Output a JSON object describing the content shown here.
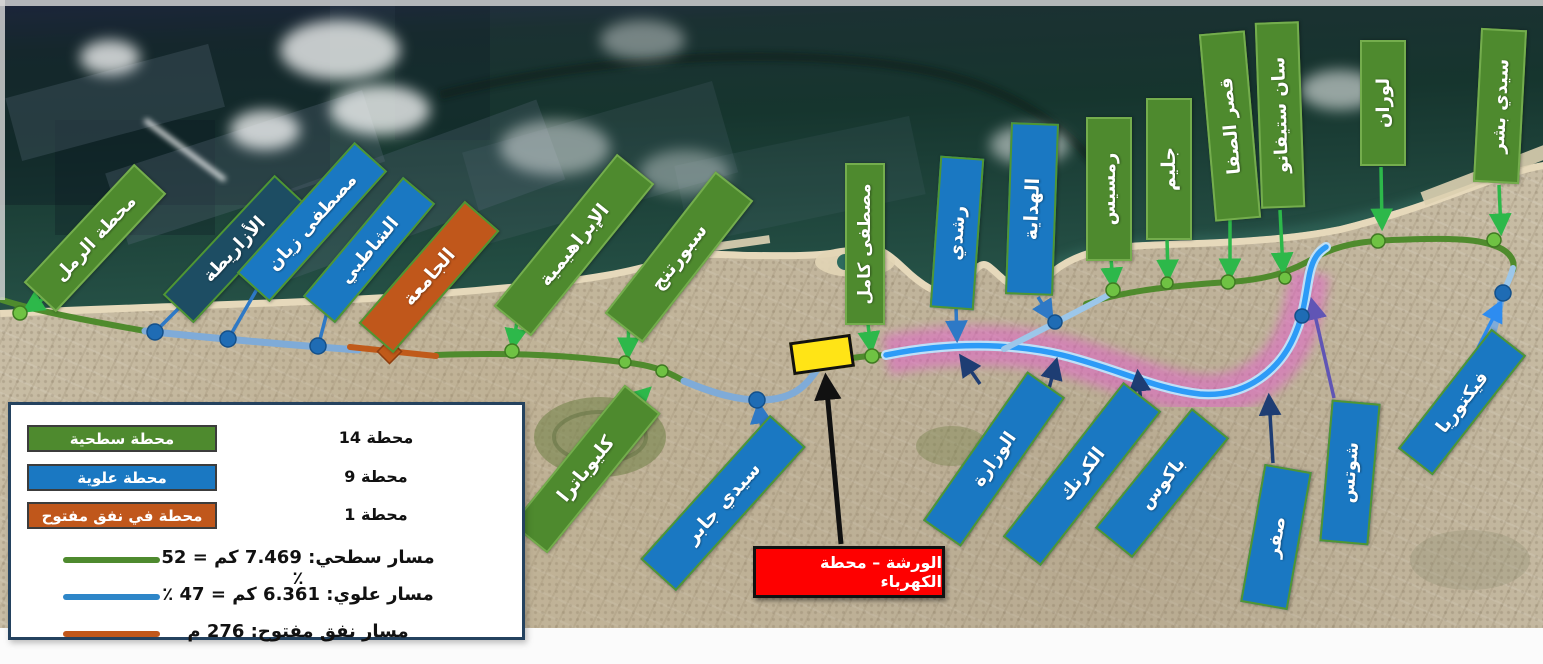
{
  "legend": {
    "station_types": [
      {
        "label": "محطة سطحية",
        "count": "14 محطة",
        "color": "#4e8a2e"
      },
      {
        "label": "محطة علوية",
        "count": "9 محطة",
        "color": "#1a78c2"
      },
      {
        "label": "محطة في نفق مفتوح",
        "count": "1 محطة",
        "color": "#c0571b"
      }
    ],
    "route_types": [
      {
        "label": "مسار سطحي: 7.469 كم = 52 ٪",
        "color": "#4e8a2e"
      },
      {
        "label": "مسار علوي: 6.361 كم = 47 ٪",
        "color": "#2e86c8"
      },
      {
        "label": "مسار نفق مفتوح: 276 م",
        "color": "#c0571b"
      }
    ]
  },
  "annotation": {
    "workshop_label": "الورشة – محطة الكهرباء"
  },
  "colors": {
    "surface": "#4e8a2e",
    "elevated": "#1a78c2",
    "elevated_dark": "#1d4d63",
    "open_tunnel": "#c0571b",
    "workshop_marker": "#ffe416",
    "annotation_bg": "#fe0000",
    "elevated_route_highlight": "#ea52d4"
  },
  "map": {
    "stations": [
      {
        "name": "محطة الرمل",
        "type": "surface",
        "cx": 93,
        "cy": 236,
        "len": 158,
        "wid": 40,
        "rot": -47,
        "fs": 18
      },
      {
        "name": "الأزاريطة",
        "type": "elevated_dark",
        "cx": 232,
        "cy": 247,
        "len": 160,
        "wid": 38,
        "rot": -47,
        "fs": 18
      },
      {
        "name": "مصطفى زيان",
        "type": "elevated",
        "cx": 310,
        "cy": 220,
        "len": 172,
        "wid": 40,
        "rot": -48,
        "fs": 18
      },
      {
        "name": "الشاطبي",
        "type": "elevated",
        "cx": 367,
        "cy": 248,
        "len": 152,
        "wid": 38,
        "rot": -50,
        "fs": 18
      },
      {
        "name": "الجامعة",
        "type": "open_tunnel",
        "cx": 427,
        "cy": 275,
        "len": 158,
        "wid": 42,
        "rot": -49,
        "fs": 19
      },
      {
        "name": "الإبراهيمية",
        "type": "surface",
        "cx": 572,
        "cy": 243,
        "len": 192,
        "wid": 44,
        "rot": -51,
        "fs": 19
      },
      {
        "name": "سبورتنج",
        "type": "surface",
        "cx": 677,
        "cy": 255,
        "len": 176,
        "wid": 44,
        "rot": -52,
        "fs": 19
      },
      {
        "name": "كليوباترا",
        "type": "surface",
        "cx": 584,
        "cy": 467,
        "len": 176,
        "wid": 42,
        "rot": -51,
        "fs": 19
      },
      {
        "name": "سيدي جابر",
        "type": "elevated",
        "cx": 721,
        "cy": 501,
        "len": 190,
        "wid": 44,
        "rot": -48,
        "fs": 19
      },
      {
        "name": "مصطفى كامل",
        "type": "surface",
        "cx": 863,
        "cy": 242,
        "len": 158,
        "wid": 36,
        "rot": -90,
        "fs": 17
      },
      {
        "name": "رشدي",
        "type": "elevated",
        "cx": 955,
        "cy": 231,
        "len": 148,
        "wid": 40,
        "rot": -86,
        "fs": 18
      },
      {
        "name": "الهداية",
        "type": "elevated",
        "cx": 1030,
        "cy": 207,
        "len": 168,
        "wid": 44,
        "rot": -88,
        "fs": 19
      },
      {
        "name": "رمسيس",
        "type": "surface",
        "cx": 1107,
        "cy": 187,
        "len": 140,
        "wid": 42,
        "rot": -90,
        "fs": 18
      },
      {
        "name": "جليم",
        "type": "surface",
        "cx": 1167,
        "cy": 167,
        "len": 138,
        "wid": 42,
        "rot": -90,
        "fs": 19
      },
      {
        "name": "قصر الصفا",
        "type": "surface",
        "cx": 1228,
        "cy": 124,
        "len": 184,
        "wid": 42,
        "rot": -95,
        "fs": 18
      },
      {
        "name": "سان ستيفانو",
        "type": "surface",
        "cx": 1278,
        "cy": 113,
        "len": 182,
        "wid": 40,
        "rot": -92,
        "fs": 18
      },
      {
        "name": "لوران",
        "type": "surface",
        "cx": 1381,
        "cy": 101,
        "len": 122,
        "wid": 42,
        "rot": -90,
        "fs": 18
      },
      {
        "name": "سيدي بشر",
        "type": "surface",
        "cx": 1498,
        "cy": 104,
        "len": 150,
        "wid": 42,
        "rot": -87,
        "fs": 18
      },
      {
        "name": "الوزارة",
        "type": "elevated",
        "cx": 992,
        "cy": 457,
        "len": 178,
        "wid": 42,
        "rot": -55,
        "fs": 18
      },
      {
        "name": "الكرنك",
        "type": "elevated",
        "cx": 1080,
        "cy": 472,
        "len": 192,
        "wid": 44,
        "rot": -52,
        "fs": 19
      },
      {
        "name": "باكوس",
        "type": "elevated",
        "cx": 1160,
        "cy": 481,
        "len": 150,
        "wid": 44,
        "rot": -51,
        "fs": 18
      },
      {
        "name": "صفر",
        "type": "elevated",
        "cx": 1274,
        "cy": 535,
        "len": 136,
        "wid": 44,
        "rot": -80,
        "fs": 18
      },
      {
        "name": "شوتس",
        "type": "elevated",
        "cx": 1348,
        "cy": 470,
        "len": 138,
        "wid": 45,
        "rot": -85,
        "fs": 18
      },
      {
        "name": "فيكتوريا",
        "type": "elevated",
        "cx": 1460,
        "cy": 400,
        "len": 148,
        "wid": 40,
        "rot": -52,
        "fs": 18
      }
    ]
  }
}
